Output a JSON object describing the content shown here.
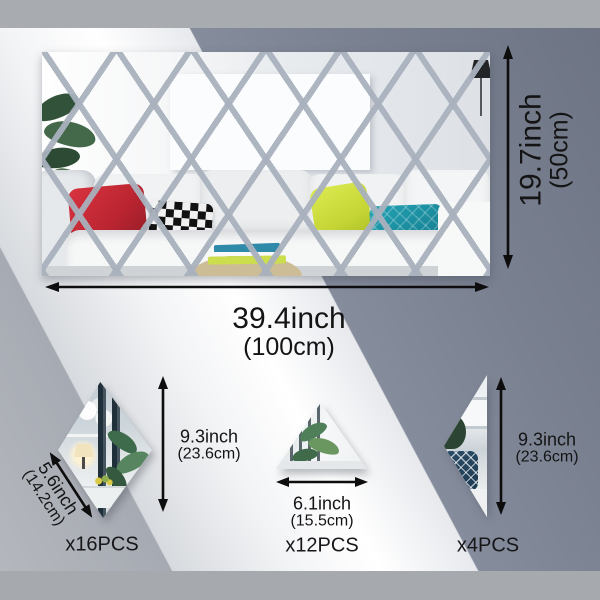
{
  "main_mirror": {
    "width_inch": "39.4inch",
    "width_cm": "(100cm)",
    "height_inch": "19.7inch",
    "height_cm": "(50cm)"
  },
  "rhombus_piece": {
    "height_inch": "9.3inch",
    "height_cm": "(23.6cm)",
    "width_inch": "5.6inch",
    "width_cm": "(14.2cm)",
    "count": "x16PCS"
  },
  "triangle_piece": {
    "width_inch": "6.1inch",
    "width_cm": "(15.5cm)",
    "count": "x12PCS"
  },
  "half_piece": {
    "height_inch": "9.3inch",
    "height_cm": "(23.6cm)",
    "count": "x4PCS"
  },
  "colors": {
    "arrow_and_text": "#0d0d0d",
    "backdrop_light": "#f5f6f8",
    "backdrop_dark": "#79808f",
    "backdrop_gray": "#a9adb5",
    "top_bottom_bars": "#a8abb0",
    "mirror_grid_line": "#a8b1bd",
    "pillow_red": "#bb2531",
    "pillow_yellow": "#c4d534",
    "pillow_teal": "#1d93a5"
  }
}
